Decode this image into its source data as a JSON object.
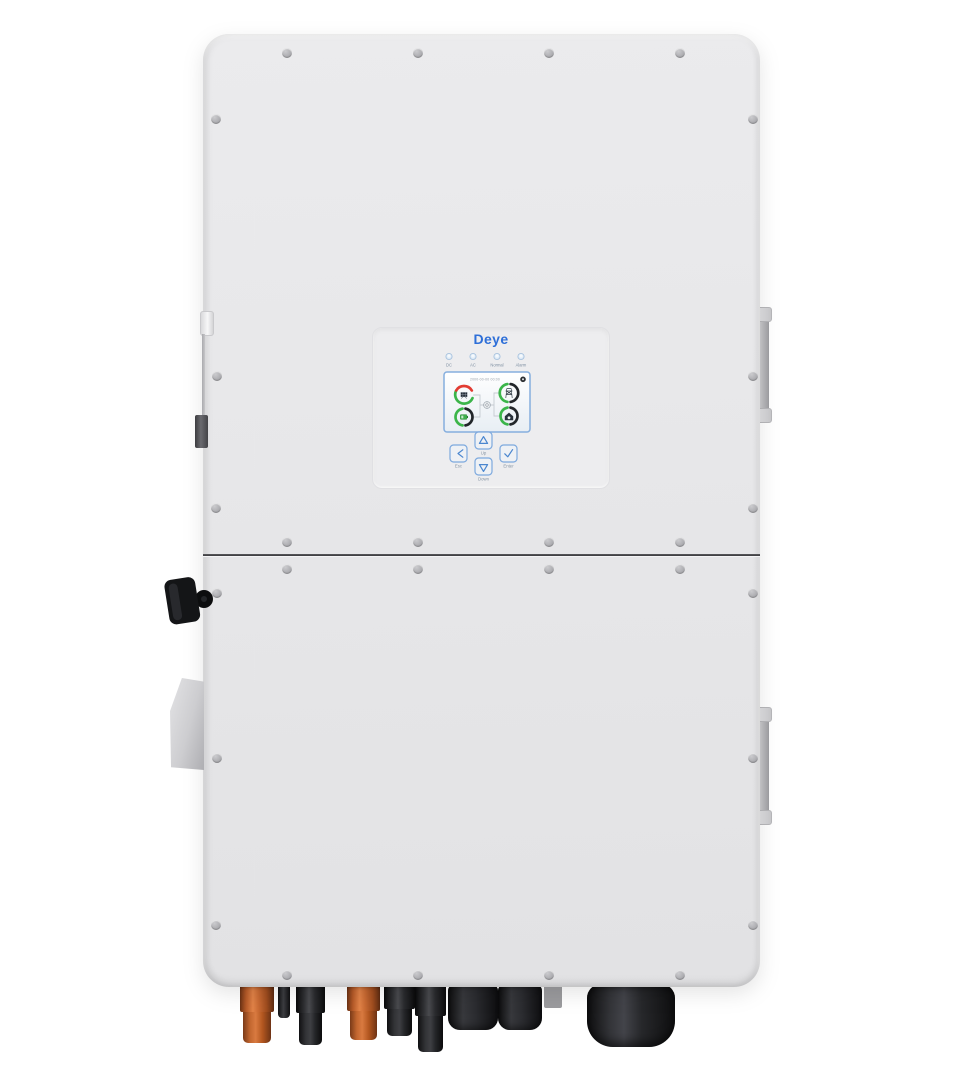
{
  "colors": {
    "brand-blue": "#2e6fd8",
    "button-blue": "#4a86cf",
    "gauge-green": "#3bb54a",
    "gauge-red": "#e23b32",
    "gauge-dark": "#22262a",
    "connector-orange": "#c96a33",
    "connector-black": "#1b1c1e",
    "body-gray": "#e7e7e9",
    "lcd-border": "#85aede"
  },
  "panel": {
    "logo_text": "Deye",
    "leds": [
      {
        "name": "dc",
        "label": "DC"
      },
      {
        "name": "ac",
        "label": "AC"
      },
      {
        "name": "normal",
        "label": "Normal"
      },
      {
        "name": "alarm",
        "label": "Alarm"
      }
    ],
    "lcd": {
      "datetime": "2000-00-00 00:00",
      "gauges": [
        {
          "name": "pv",
          "icon": "solar-panel-icon"
        },
        {
          "name": "grid",
          "icon": "power-tower-icon"
        },
        {
          "name": "battery",
          "icon": "battery-icon"
        },
        {
          "name": "load",
          "icon": "house-icon"
        }
      ]
    },
    "buttons": [
      {
        "name": "esc",
        "label": "Esc"
      },
      {
        "name": "up",
        "label": "Up"
      },
      {
        "name": "down",
        "label": "Down"
      },
      {
        "name": "enter",
        "label": "Enter"
      }
    ]
  }
}
